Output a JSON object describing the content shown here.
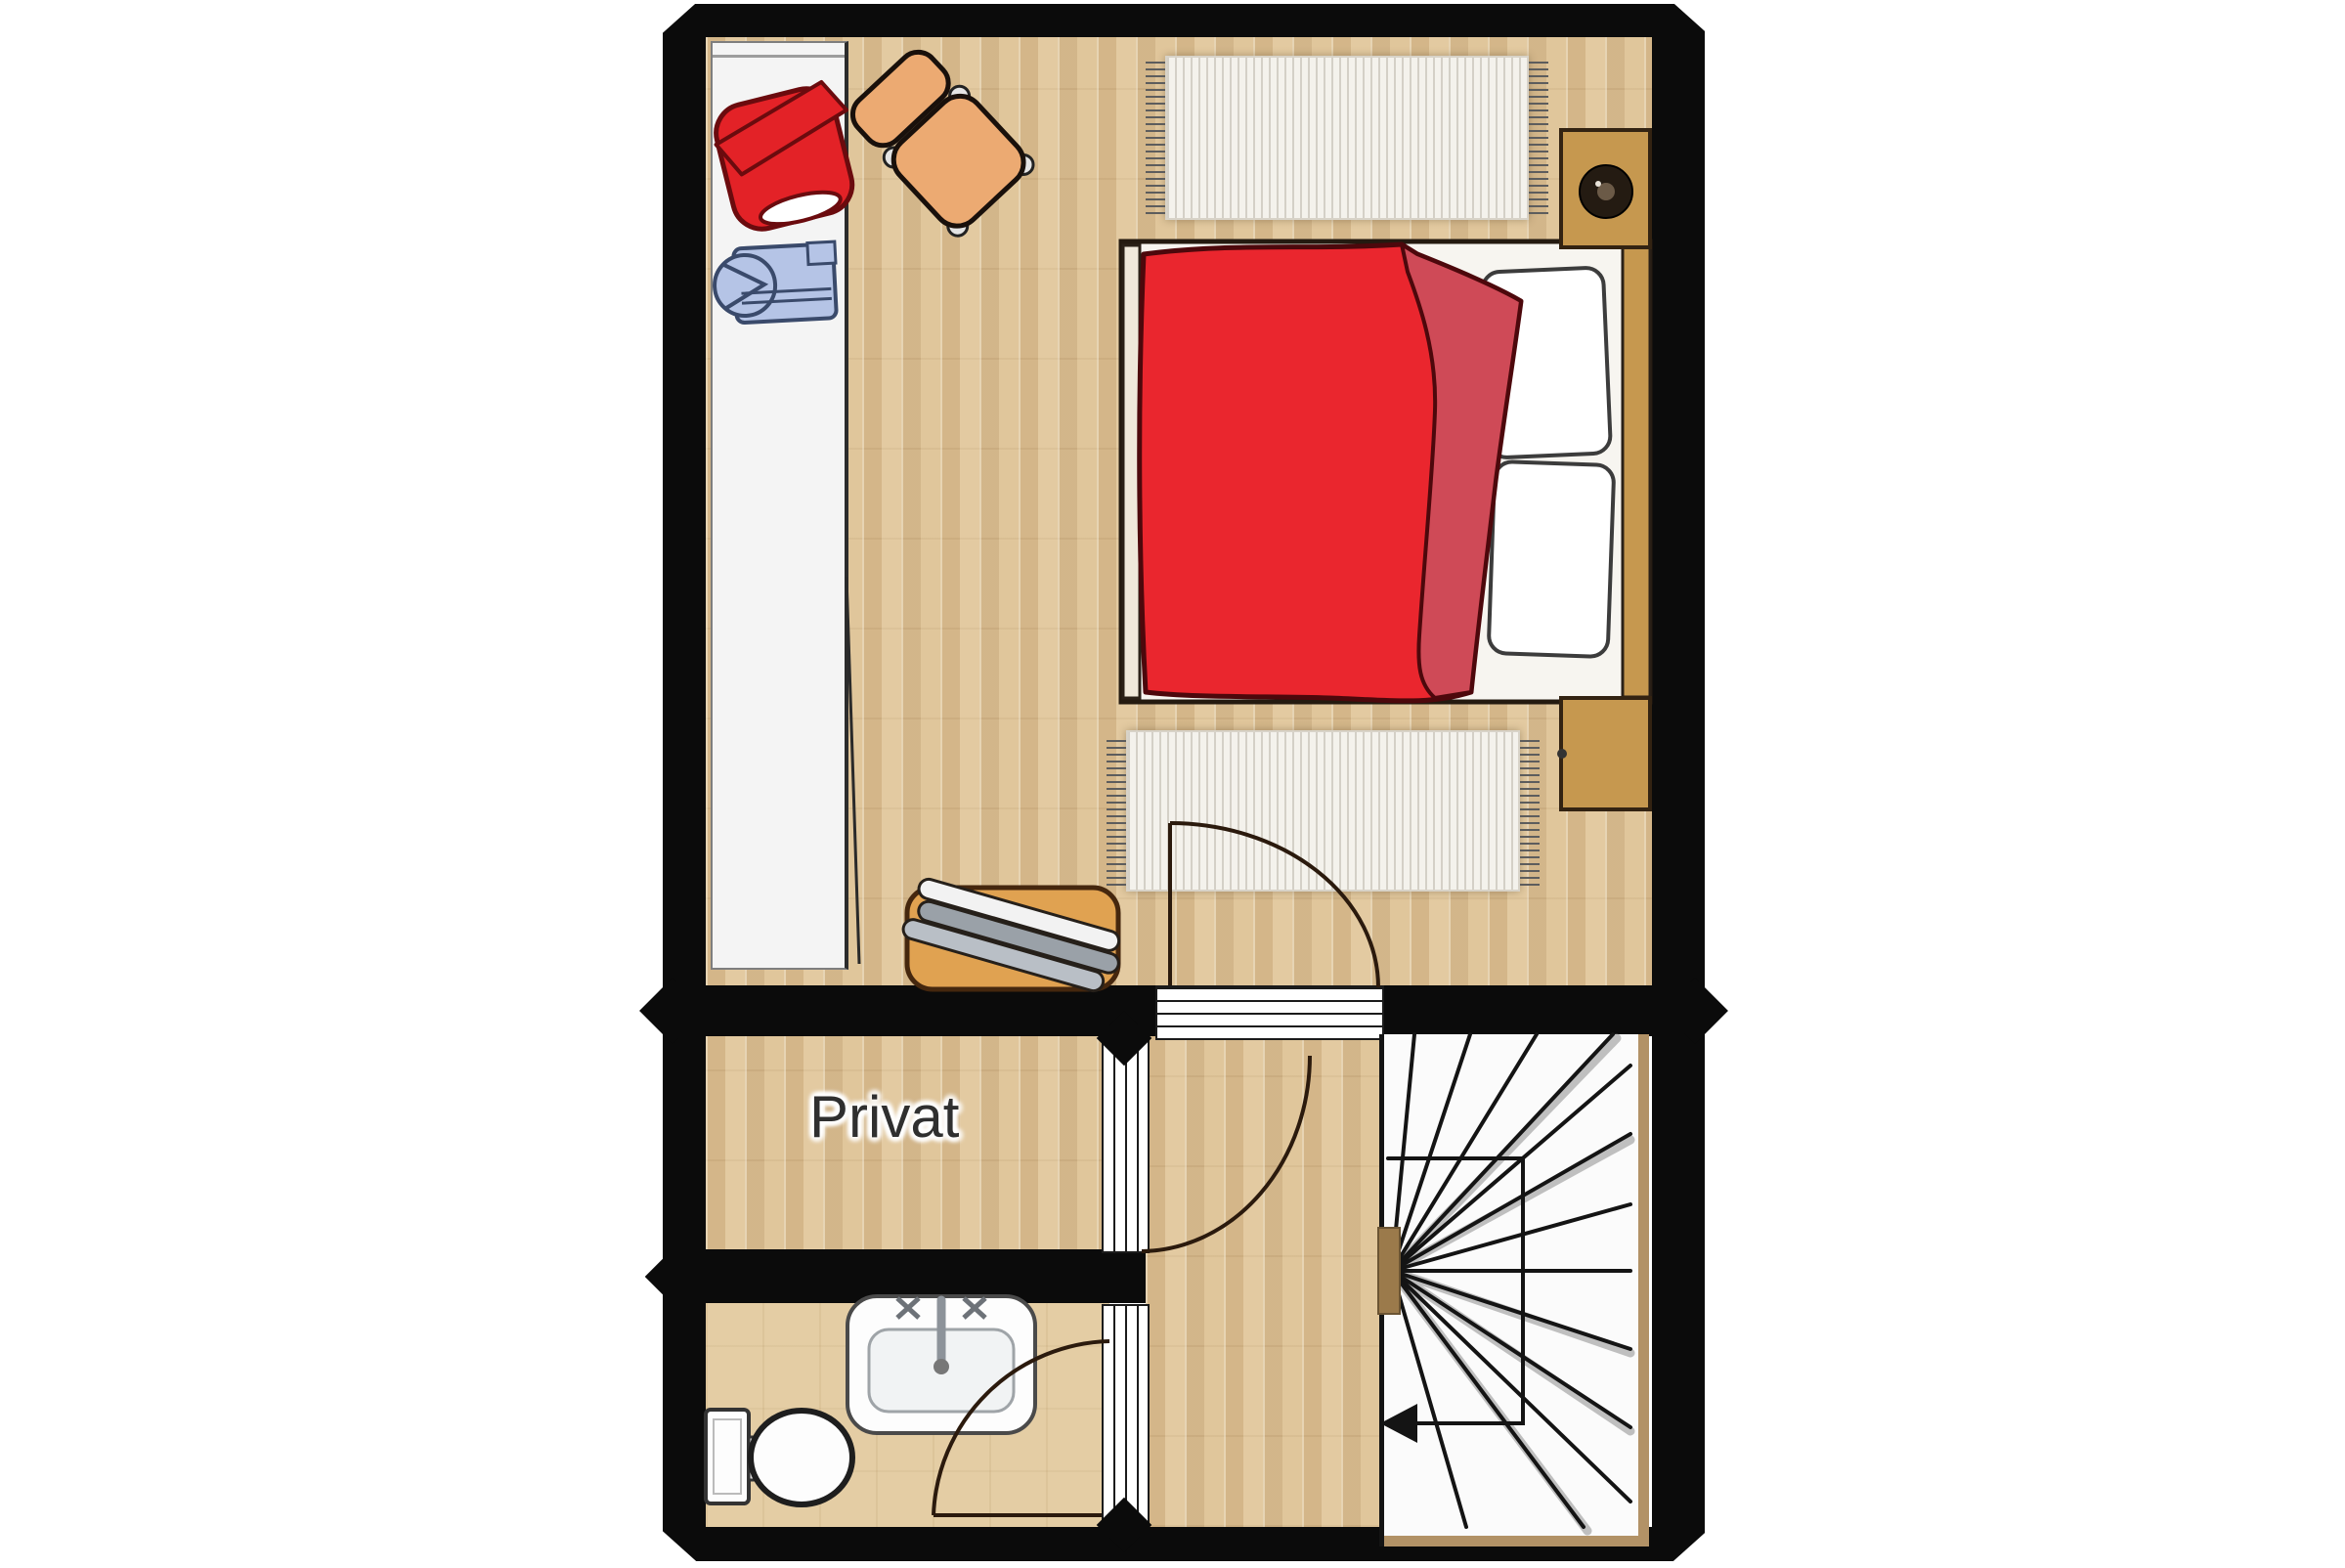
{
  "floorplan": {
    "room_label": "Privat",
    "colors": {
      "wall": "#0b0b0b",
      "wood_floor": "#dfc49a",
      "bath_floor": "#e4cda4",
      "stair_area": "#fbfbfb",
      "stair_stringer": "#b29266",
      "stair_hub": "#9b7a4b",
      "tread_line": "#141414",
      "door_arc": "#2b1a0d",
      "bed_base": "#f7f5f0",
      "duvet": "#ea262e",
      "duvet_fold": "#cf4a57",
      "pillow": "#ffffff",
      "footboard": "#efe8da",
      "nightstand": "#c6984f",
      "lamp": "#241b12",
      "chair": "#ecaa72",
      "bench": "#e0a251",
      "bench_slat_light": "#f2f2f2",
      "bench_slat_gray": "#9aa1a8",
      "jacket": "#e32227",
      "shirt": "#b5c4e6",
      "fixture_white": "#fdfdfd",
      "rug": "#f4f2ec",
      "wardrobe": "#f4f4f4"
    },
    "objects": [
      "wardrobe",
      "red-jacket",
      "blue-shirt",
      "armchair",
      "rug-top",
      "double-bed",
      "nightstand-with-lamp",
      "nightstand",
      "rug-bottom",
      "bench-with-slats",
      "bedroom-door",
      "hall-door",
      "bathroom-door",
      "sink",
      "toilet",
      "winder-staircase",
      "stair-walk-line",
      "down-arrow"
    ]
  }
}
